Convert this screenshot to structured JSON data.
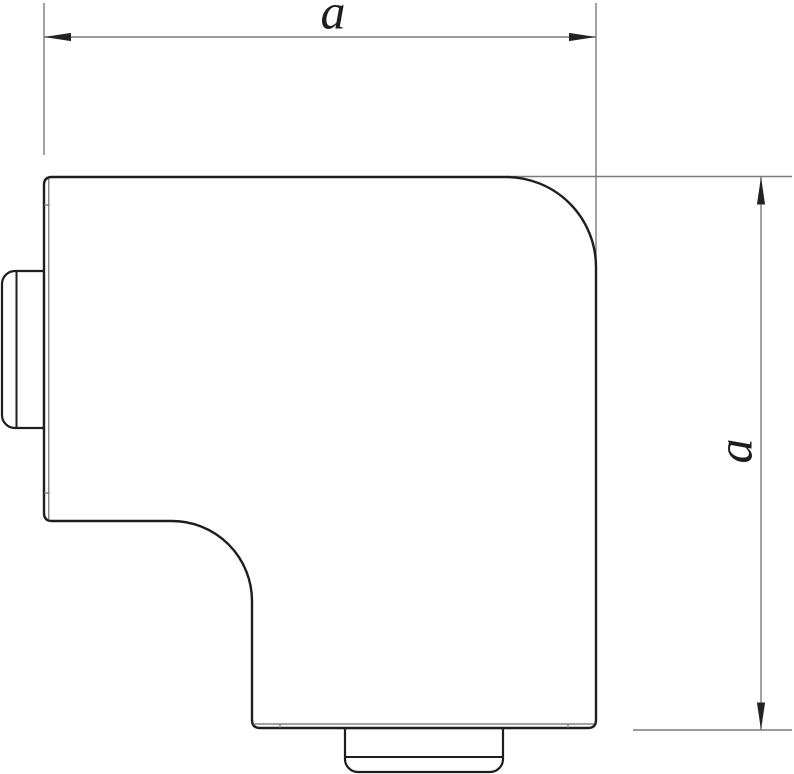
{
  "figure": {
    "background_color": "#ffffff",
    "outline_color": "#1e1e1e",
    "edge_line_color": "#6a6a6a",
    "dimension_line_color": "#7a7a7a",
    "arrow_color": "#232323",
    "label_color": "#1d1d1d",
    "dimensions": [
      {
        "label": "a",
        "orientation": "horizontal",
        "position": "top"
      },
      {
        "label": "a",
        "orientation": "vertical",
        "position": "right"
      }
    ]
  }
}
